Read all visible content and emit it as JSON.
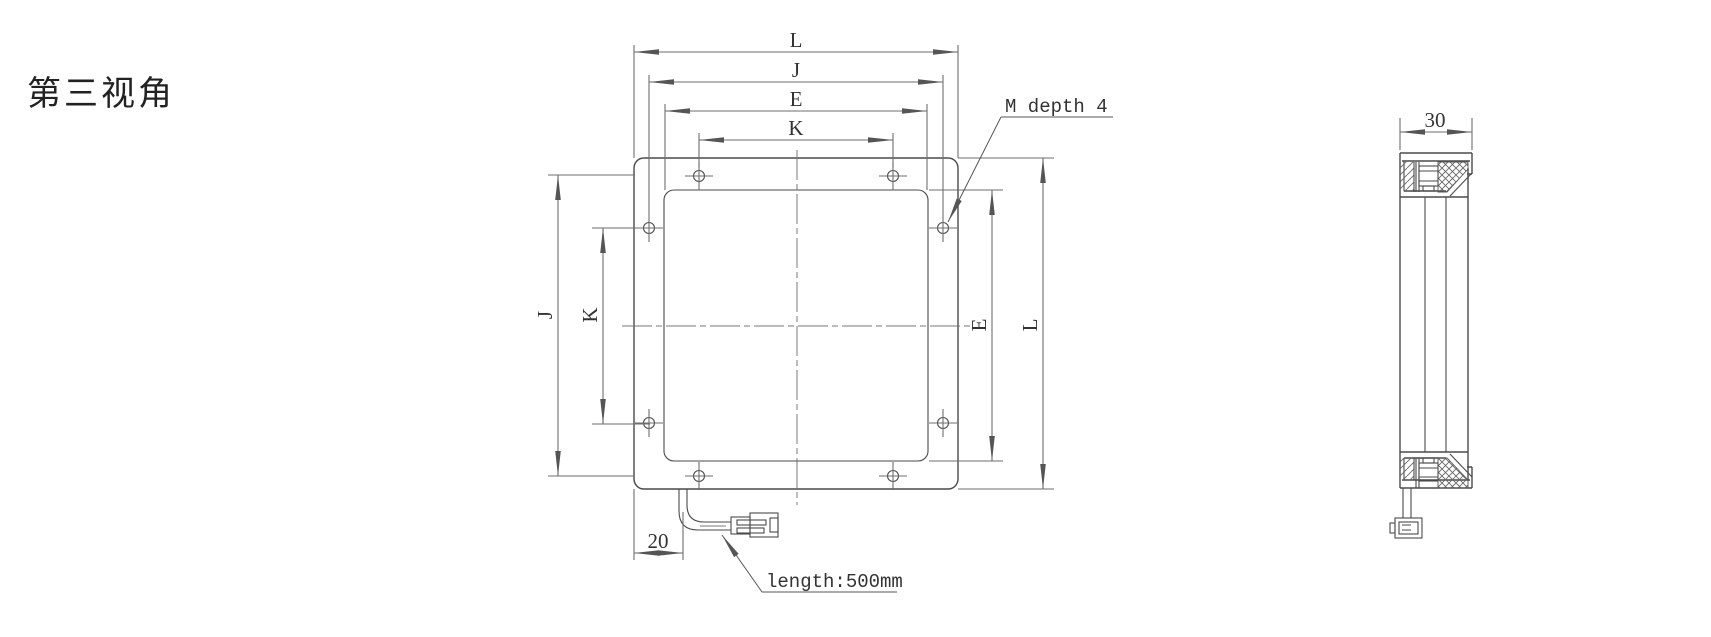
{
  "title": "第三视角",
  "front_view": {
    "dim_top_outer": "L",
    "dim_top_bolt": "J",
    "dim_top_emit": "E",
    "dim_top_hole": "K",
    "dim_left_bolt": "J",
    "dim_left_hole": "K",
    "dim_right_emit": "E",
    "dim_right_outer": "L",
    "cable_offset_dim": "20",
    "thread_callout": "M depth 4",
    "cable_length_callout": "length:500mm"
  },
  "side_view": {
    "depth_dim": "30"
  },
  "colors": {
    "object_line": "#4a4a4a",
    "dimension_line": "#6e6e6e",
    "centerline": "#777777",
    "text": "#333333",
    "background": "#ffffff"
  }
}
